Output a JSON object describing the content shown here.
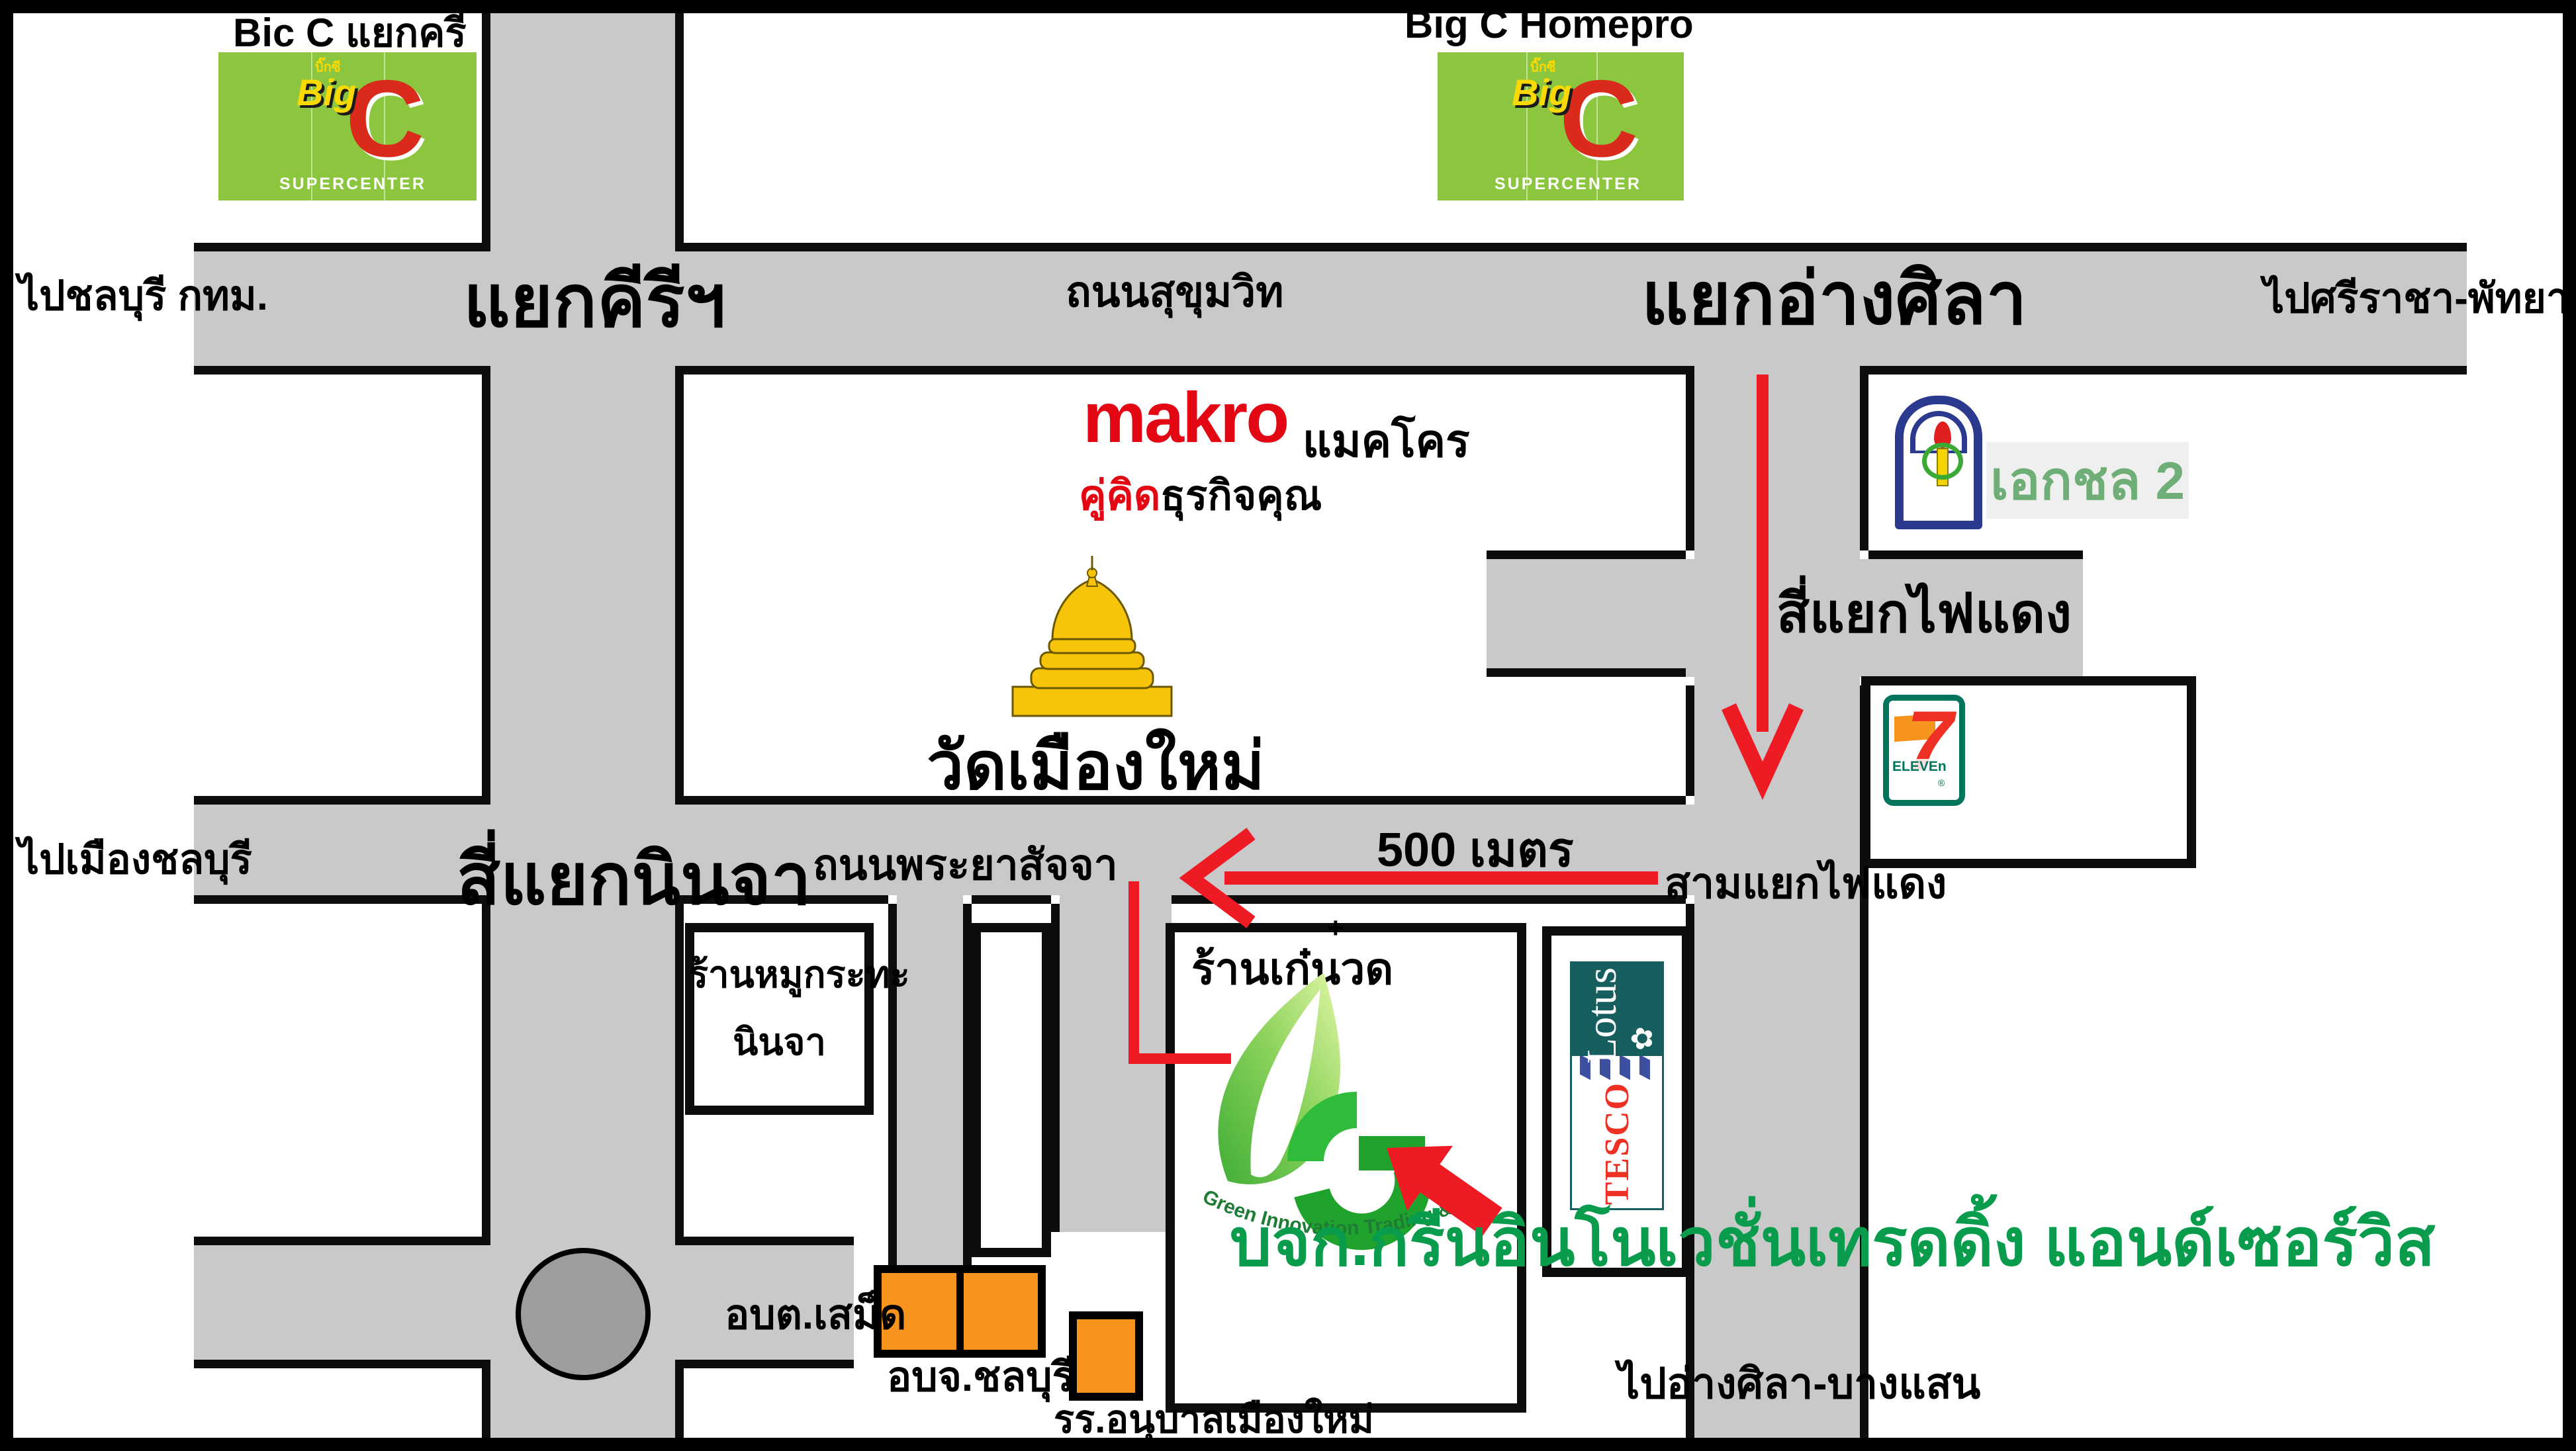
{
  "labels": {
    "big_c_intersection_caption": "Bic C แยกครี",
    "big_c_homepro_caption": "Big C Homepro",
    "to_chonburi_bkk": "ไปชลบุรี กทม.",
    "yaek_kiri": "แยกคีรีฯ",
    "sukhumvit_road": "ถนนสุขุมวิท",
    "yaek_ang_sila": "แยกอ่างศิลา",
    "to_sriracha_pattaya": "ไปศรีราชา-พัทยา",
    "makro_thai": "แมคโคร",
    "wat_muang_mai": "วัดเมืองใหม่",
    "si_yaek_fai_daeng": "สี่แยกไฟแดง",
    "to_muang_chonburi": "ไปเมืองชลบุรี",
    "si_yaek_ninja": "สี่แยกนินจา",
    "phraya_satja_road": "ถนนพระยาสัจจา",
    "distance_500m": "500 เมตร",
    "sam_yaek_fai_daeng": "สามแยกไฟแดง",
    "ran_kae_nuat": "ร้านเก๋นวด",
    "plus_mark": "+",
    "mukrata_line1": "ร้านหมูกระทะ",
    "mukrata_line2": "นินจา",
    "obt_samed": "อบต.เสม็ด",
    "obj_chonburi": "อบจ.ชลบุรี",
    "anuban_school": "รร.อนุบาลเมืองใหม่",
    "to_ang_sila_bangsaen": "ไปอ่างศิลา-บางแสน",
    "company_name": "บจก.กรีนอินโนเวชั่นเทรดดิ้ง แอนด์เซอร์วิส"
  },
  "logos": {
    "big_c": {
      "mini_thai": "บิ๊กซี",
      "big": "Big",
      "c": "C",
      "supercenter": "SUPERCENTER"
    },
    "makro": {
      "wordmark": "makro",
      "tagline_red": "คู่คิด",
      "tagline_black": "ธุรกิจคุณ"
    },
    "ekachol": {
      "label": "เอกชล 2"
    },
    "tesco_lotus": {
      "tesco": "TESCO",
      "lotus": "Lotus",
      "flower": "✿"
    },
    "seven_eleven": {
      "seven": "7",
      "eleven": "ELEVEn",
      "reg": "®"
    },
    "green_innovation": {
      "curved_text": "Green Innovation Trading & Service Co.,Ltd."
    }
  },
  "colors": {
    "road_gray": "#c9c9c9",
    "roundabout_gray": "#9d9d9d",
    "arrow_red": "#ee1b24",
    "bigc_green": "#8cc63f",
    "bigc_red": "#d92a1c",
    "bigc_yellow": "#fcd900",
    "makro_red": "#e30613",
    "tesco_red": "#ee3124",
    "tesco_blue": "#3c4fa0",
    "lotus_teal": "#175f5f",
    "seven_green": "#00755e",
    "seven_orange": "#f7941d",
    "ekachol_blue": "#2b3a8f",
    "ekachol_green": "#6fae77",
    "company_green": "#089c4c",
    "temple_gold": "#f6c50a"
  }
}
